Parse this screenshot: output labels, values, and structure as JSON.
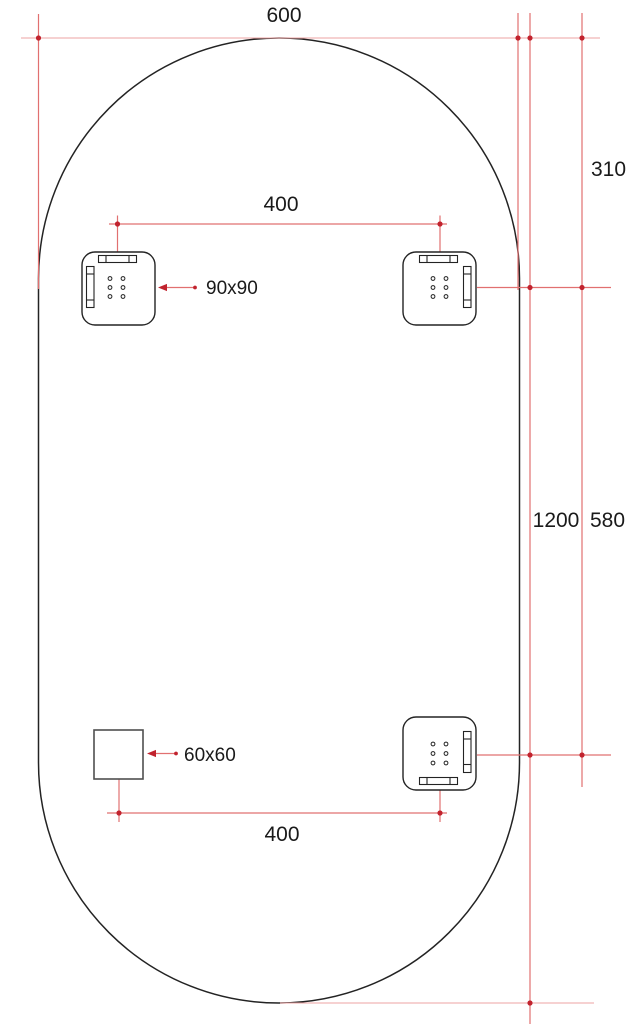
{
  "drawing": {
    "type": "technical-dimension-drawing",
    "subject": "oval-stadium-panel-with-mounting-brackets",
    "labels": {
      "overall_width": "600",
      "overall_height": "1200",
      "top_edge_to_brackets": "310",
      "brackets_vertical_span": "580",
      "top_brackets_spacing": "400",
      "bottom_brackets_spacing": "400",
      "bracket_size": "90x90",
      "plate_size": "60x60"
    },
    "colors": {
      "outline": "#232323",
      "dimension_line": "#e17070",
      "dimension_marker": "#c1232e",
      "plate_outline": "#4f4f4f",
      "text": "#1a1a1a"
    }
  }
}
